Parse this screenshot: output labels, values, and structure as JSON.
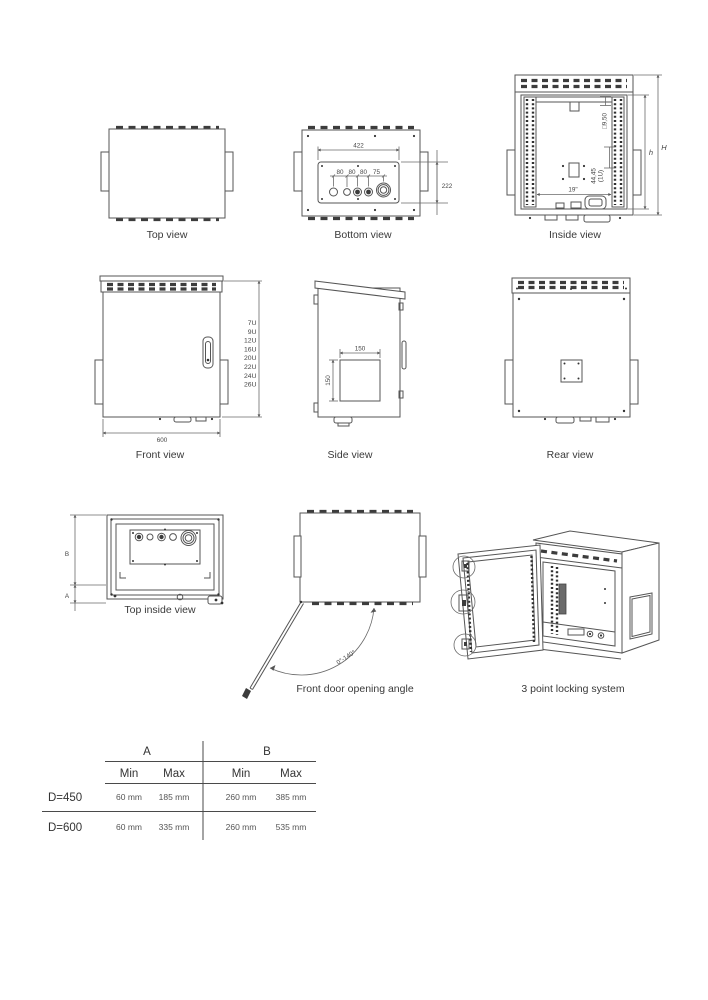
{
  "captions": {
    "top_view": "Top view",
    "bottom_view": "Bottom view",
    "inside_view": "Inside view",
    "front_view": "Front view",
    "side_view": "Side view",
    "rear_view": "Rear view",
    "top_inside_view": "Top inside view",
    "door_angle": "Front door opening angle",
    "locking": "3 point locking system"
  },
  "bottom_view": {
    "dim_width": "422",
    "dim_height": "222",
    "hole_dims": [
      "80",
      "80",
      "80",
      "75"
    ]
  },
  "inside_view": {
    "dim_square": "□9,50",
    "dim_1u": "44,45",
    "dim_1u_unit": "(1U)",
    "dim_rack": "19\"",
    "dim_inner_height": "h",
    "dim_total_height": "H"
  },
  "front_view": {
    "dim_width": "600",
    "rack_units": [
      "7U",
      "9U",
      "12U",
      "16U",
      "20U",
      "22U",
      "24U",
      "26U"
    ]
  },
  "side_view": {
    "dim_w": "150",
    "dim_h": "150"
  },
  "top_inside_view": {
    "dim_b": "B",
    "dim_a": "A"
  },
  "door_angle": {
    "range": "0°-140°"
  },
  "table": {
    "col_groups": [
      "A",
      "B"
    ],
    "sub_headers": [
      "Min",
      "Max",
      "Min",
      "Max"
    ],
    "rows": [
      {
        "label": "D=450",
        "a_min": "60 mm",
        "a_max": "185 mm",
        "b_min": "260 mm",
        "b_max": "385 mm"
      },
      {
        "label": "D=600",
        "a_min": "60 mm",
        "a_max": "335 mm",
        "b_min": "260 mm",
        "b_max": "535 mm"
      }
    ]
  },
  "colors": {
    "line": "#555555",
    "dark": "#333333",
    "text": "#3a3a3a"
  }
}
